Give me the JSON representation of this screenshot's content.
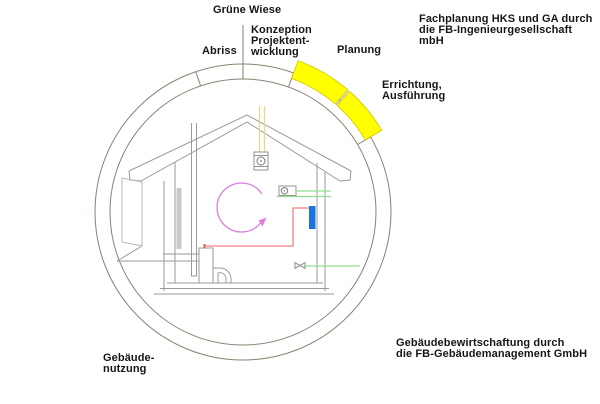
{
  "labels": {
    "gruene_wiese": "Grüne Wiese",
    "abriss": "Abriss",
    "konzeption": "Konzeption\nProjektent-\nwicklung",
    "planung": "Planung",
    "errichtung": "Errichtung,\nAusführung",
    "fachplanung_note": "Fachplanung HKS und GA durch\ndie FB-Ingenieurgesellschaft mbH",
    "bewirtschaftung_note": "Gebäudebewirtschaftung durch\ndie FB-Gebäudemanagement GmbH",
    "nutzung": "Gebäude-\nnutzung"
  },
  "lifecycle": {
    "phases": [
      "Grüne Wiese",
      "Konzeption Projektentwicklung",
      "Planung",
      "Errichtung, Ausführung",
      "Gebäudenutzung",
      "Abriss"
    ],
    "highlighted_phases": [
      "Planung",
      "Errichtung, Ausführung"
    ]
  },
  "colors": {
    "highlight_yellow": "#ffff00",
    "ring_line": "#8a8272",
    "drawing_line": "#9a9a9a",
    "pipe_pink": "#f08080",
    "pipe_red": "#e05858",
    "circulation_violet": "#dd7ddd",
    "duct_green": "#8fdd8f",
    "radiator_blue": "#1874dc",
    "vent_yellow": "#e8d88a"
  }
}
